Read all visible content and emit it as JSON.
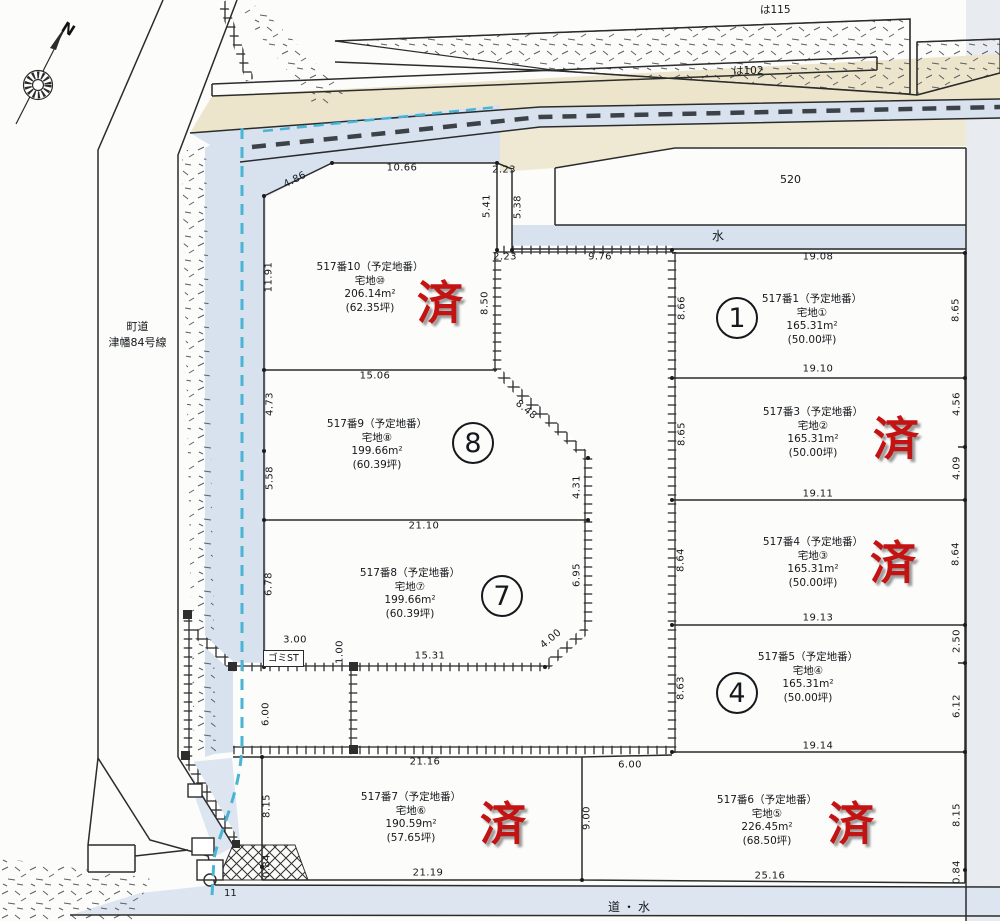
{
  "compass": {
    "north": "N"
  },
  "labels": {
    "ha115": "は115",
    "ha102": "は102",
    "parcel520": "520",
    "water": "水",
    "road_water": "道・水",
    "town_road_line1": "町道",
    "town_road_line2": "津幡84号線",
    "gomi_st": "ゴミST",
    "eleven": "11"
  },
  "lots": [
    {
      "id": "517-10",
      "name": "517番10（予定地番）",
      "lot": "宅地⑩",
      "area": "206.14m²",
      "tsubo": "(62.35坪)",
      "marker": "済",
      "marker_type": "sold"
    },
    {
      "id": "517-9",
      "name": "517番9（予定地番）",
      "lot": "宅地⑧",
      "area": "199.66m²",
      "tsubo": "(60.39坪)",
      "marker": "8",
      "marker_type": "circle"
    },
    {
      "id": "517-8",
      "name": "517番8（予定地番）",
      "lot": "宅地⑦",
      "area": "199.66m²",
      "tsubo": "(60.39坪)",
      "marker": "7",
      "marker_type": "circle"
    },
    {
      "id": "517-7",
      "name": "517番7（予定地番）",
      "lot": "宅地⑥",
      "area": "190.59m²",
      "tsubo": "(57.65坪)",
      "marker": "済",
      "marker_type": "sold"
    },
    {
      "id": "517-6",
      "name": "517番6（予定地番）",
      "lot": "宅地⑤",
      "area": "226.45m²",
      "tsubo": "(68.50坪)",
      "marker": "済",
      "marker_type": "sold"
    },
    {
      "id": "517-1",
      "name": "517番1（予定地番）",
      "lot": "宅地①",
      "area": "165.31m²",
      "tsubo": "(50.00坪)",
      "marker": "1",
      "marker_type": "circle"
    },
    {
      "id": "517-3",
      "name": "517番3（予定地番）",
      "lot": "宅地②",
      "area": "165.31m²",
      "tsubo": "(50.00坪)",
      "marker": "済",
      "marker_type": "sold"
    },
    {
      "id": "517-4",
      "name": "517番4（予定地番）",
      "lot": "宅地③",
      "area": "165.31m²",
      "tsubo": "(50.00坪)",
      "marker": "済",
      "marker_type": "sold"
    },
    {
      "id": "517-5",
      "name": "517番5（予定地番）",
      "lot": "宅地④",
      "area": "165.31m²",
      "tsubo": "(50.00坪)",
      "marker": "4",
      "marker_type": "circle"
    }
  ],
  "dims": [
    "10.66",
    "4.86",
    "2.23",
    "5.41",
    "5.38",
    "2.23",
    "9.76",
    "19.08",
    "11.91",
    "8.50",
    "8.66",
    "8.65",
    "15.06",
    "19.10",
    "4.73",
    "8.48",
    "8.65",
    "4.56",
    "4.09",
    "5.58",
    "4.31",
    "21.10",
    "19.11",
    "8.64",
    "8.64",
    "6.78",
    "6.95",
    "19.13",
    "3.00",
    "1.00",
    "15.31",
    "4.00",
    "8.63",
    "2.50",
    "6.12",
    "6.00",
    "21.16",
    "19.14",
    "6.00",
    "8.15",
    "9.00",
    "8.15",
    "0.84",
    "0.84",
    "21.19",
    "25.16"
  ],
  "colors": {
    "sold_red": "#c31313",
    "water_blue": "#d8e2ee",
    "road_cream": "#ece5cb",
    "cyan_channel": "#49b4d4",
    "line": "#2b2b2b"
  }
}
